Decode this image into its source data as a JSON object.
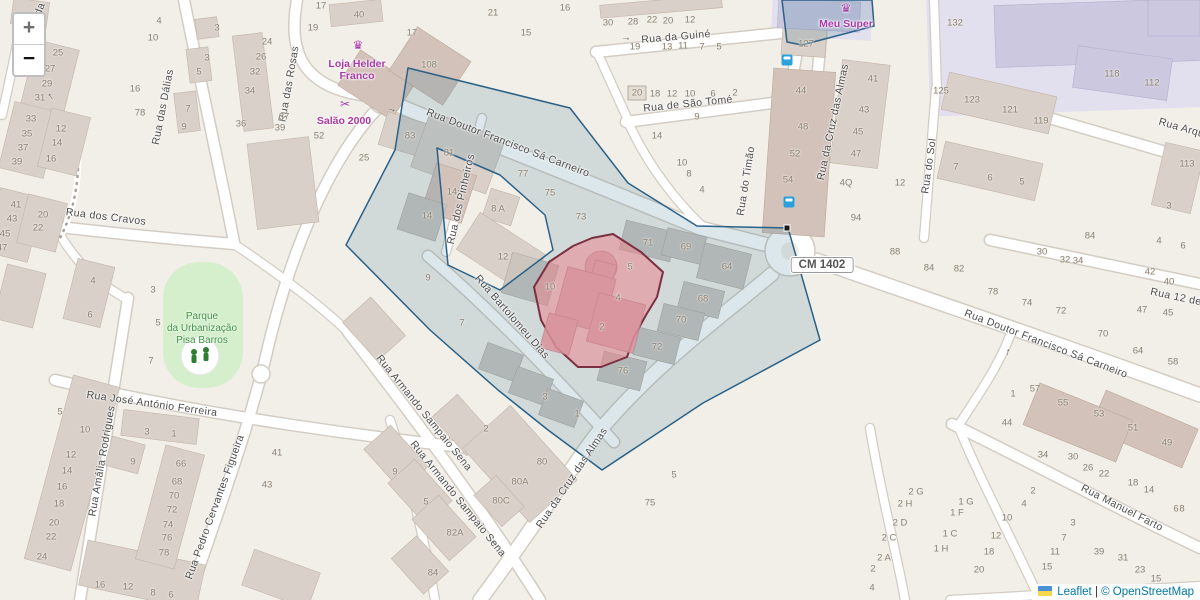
{
  "map": {
    "colors": {
      "background": "#f2efe9",
      "building": "#d9d0c9",
      "retail_building": "#cbc8e0",
      "park": "#d5efcd",
      "selection_fill": "#31708e",
      "selection_stroke": "#2a6187",
      "highlight_fill": "#ee828a",
      "highlight_stroke": "#7c2f41",
      "poi": "#aa38a6",
      "leaflet_link": "#0078A8",
      "bus": "#2aa0dc"
    },
    "controls": {
      "zoom_in": "+",
      "zoom_out": "−"
    },
    "attribution": {
      "leaflet": "Leaflet",
      "separator": " | ",
      "osm": "© OpenStreetMap"
    },
    "road_shield": "CM 1402",
    "park": {
      "name_lines": [
        "Parque",
        "da Urbanização",
        "Pisa Barros"
      ],
      "x": 202,
      "y": 329
    },
    "pois": [
      {
        "id": "loja-helder-franco",
        "lines": [
          "Loja Helder",
          "Franco"
        ],
        "icon": "crown",
        "ix": 358,
        "iy": 45,
        "x": 357,
        "y": 70
      },
      {
        "id": "salao-2000",
        "lines": [
          "Salão 2000"
        ],
        "icon": "scissors",
        "ix": 345,
        "iy": 104,
        "x": 344,
        "y": 121
      },
      {
        "id": "meu-super",
        "lines": [
          "Meu Super"
        ],
        "icon": "crown",
        "ix": 846,
        "iy": 8,
        "x": 846,
        "y": 24
      }
    ],
    "street_labels": [
      {
        "text": "Rua das Dálias",
        "x": 163,
        "y": 107,
        "rot": -79
      },
      {
        "text": "Rua das Rosas",
        "x": 289,
        "y": 84,
        "rot": -80
      },
      {
        "text": "Rua dos Cravos",
        "x": 106,
        "y": 217,
        "rot": 7
      },
      {
        "text": "Rua Doutor Francisco Sá Carneiro",
        "x": 508,
        "y": 143,
        "rot": 21
      },
      {
        "text": "Rua da Guiné",
        "x": 676,
        "y": 37,
        "rot": -5
      },
      {
        "text": "Rua de São Tomé",
        "x": 688,
        "y": 104,
        "rot": -6
      },
      {
        "text": "Rua do Timão",
        "x": 746,
        "y": 181,
        "rot": -81
      },
      {
        "text": "Rua da Cruz das Almas",
        "x": 833,
        "y": 122,
        "rot": -78
      },
      {
        "text": "Rua da Cruz das Almas",
        "x": 572,
        "y": 478,
        "rot": -56
      },
      {
        "text": "Rua Bartolomeu Dias",
        "x": 512,
        "y": 317,
        "rot": 49
      },
      {
        "text": "Rua dos Pinheiros",
        "x": 461,
        "y": 199,
        "rot": -77
      },
      {
        "text": "Rua Armando Sampaio Sena",
        "x": 424,
        "y": 413,
        "rot": 51
      },
      {
        "text": "Rua Armando Sampaio Sena",
        "x": 458,
        "y": 499,
        "rot": 51
      },
      {
        "text": "Rua José António Ferreira",
        "x": 152,
        "y": 404,
        "rot": 8
      },
      {
        "text": "Rua Amália Rodrigues",
        "x": 102,
        "y": 461,
        "rot": -80
      },
      {
        "text": "Rua Pedro Cervantes Figueira",
        "x": 215,
        "y": 507,
        "rot": -70
      },
      {
        "text": "Rua Manuel Farto",
        "x": 1122,
        "y": 508,
        "rot": 27
      },
      {
        "text": "Rua Doutor Francisco Sá Carneiro",
        "x": 1046,
        "y": 344,
        "rot": 21
      },
      {
        "text": "Rua 12 de",
        "x": 1176,
        "y": 297,
        "rot": 12
      },
      {
        "text": "Rua Arquiteto",
        "x": 1192,
        "y": 131,
        "rot": 16
      },
      {
        "text": "Rua do Sol",
        "x": 929,
        "y": 166,
        "rot": -82
      },
      {
        "text": "da",
        "x": 40,
        "y": 9,
        "rot": -70
      }
    ],
    "oneway_arrows": [
      {
        "x": 626,
        "y": 38,
        "rot": 0
      },
      {
        "x": 392,
        "y": 109,
        "rot": 20
      },
      {
        "x": 50,
        "y": 97,
        "rot": 235
      },
      {
        "x": 1007,
        "y": 352,
        "rot": 280
      }
    ],
    "bus_stops": [
      {
        "x": 787,
        "y": 60
      },
      {
        "x": 789,
        "y": 202
      }
    ],
    "house_numbers": [
      [
        "25",
        58,
        53
      ],
      [
        "27",
        50,
        69
      ],
      [
        "29",
        47,
        84
      ],
      [
        "31",
        40,
        98
      ],
      [
        "33",
        31,
        119
      ],
      [
        "35",
        27,
        134
      ],
      [
        "37",
        23,
        148
      ],
      [
        "39",
        17,
        162
      ],
      [
        "12",
        61,
        129
      ],
      [
        "14",
        57,
        143
      ],
      [
        "16",
        51,
        159
      ],
      [
        "41",
        16,
        205
      ],
      [
        "43",
        12,
        219
      ],
      [
        "45",
        5,
        234
      ],
      [
        "47",
        2,
        248
      ],
      [
        "20",
        43,
        215
      ],
      [
        "22",
        38,
        228
      ],
      [
        "4",
        159,
        21
      ],
      [
        "10",
        153,
        38
      ],
      [
        "16",
        135,
        89
      ],
      [
        "78",
        140,
        113
      ],
      [
        "7",
        188,
        109
      ],
      [
        "9",
        184,
        127
      ],
      [
        "3",
        217,
        28
      ],
      [
        "3",
        207,
        58
      ],
      [
        "5",
        199,
        72
      ],
      [
        "24",
        267,
        42
      ],
      [
        "26",
        261,
        57
      ],
      [
        "32",
        255,
        72
      ],
      [
        "34",
        250,
        91
      ],
      [
        "36",
        241,
        124
      ],
      [
        "37",
        284,
        117
      ],
      [
        "39",
        280,
        128
      ],
      [
        "52",
        319,
        136
      ],
      [
        "25",
        364,
        158
      ],
      [
        "17",
        321,
        6
      ],
      [
        "19",
        313,
        28
      ],
      [
        "40",
        359,
        15
      ],
      [
        "17",
        412,
        33
      ],
      [
        "108",
        429,
        65
      ],
      [
        "21",
        493,
        13
      ],
      [
        "15",
        526,
        33
      ],
      [
        "16",
        565,
        8
      ],
      [
        "83",
        410,
        136
      ],
      [
        "81",
        449,
        153
      ],
      [
        "77",
        523,
        174
      ],
      [
        "75",
        550,
        193
      ],
      [
        "73",
        581,
        217
      ],
      [
        "14",
        452,
        192
      ],
      [
        "14",
        427,
        216
      ],
      [
        "8 A",
        498,
        209
      ],
      [
        "12",
        503,
        257
      ],
      [
        "9",
        428,
        278
      ],
      [
        "7",
        462,
        323
      ],
      [
        "10",
        550,
        287
      ],
      [
        "5",
        630,
        267
      ],
      [
        "4",
        618,
        298
      ],
      [
        "2",
        602,
        327
      ],
      [
        "71",
        648,
        243
      ],
      [
        "69",
        686,
        247
      ],
      [
        "64",
        727,
        267
      ],
      [
        "68",
        703,
        299
      ],
      [
        "70",
        681,
        320
      ],
      [
        "72",
        657,
        347
      ],
      [
        "76",
        623,
        371
      ],
      [
        "30",
        608,
        23
      ],
      [
        "28",
        633,
        22
      ],
      [
        "22",
        652,
        20
      ],
      [
        "20",
        668,
        21
      ],
      [
        "12",
        690,
        20
      ],
      [
        "19",
        635,
        47
      ],
      [
        "13",
        667,
        47
      ],
      [
        "11",
        683,
        46
      ],
      [
        "7",
        702,
        47
      ],
      [
        "5",
        719,
        47
      ],
      [
        "20",
        637,
        93
      ],
      [
        "18",
        655,
        94
      ],
      [
        "12",
        672,
        94
      ],
      [
        "10",
        690,
        94
      ],
      [
        "6",
        713,
        94
      ],
      [
        "2",
        735,
        93
      ],
      [
        "9",
        697,
        117
      ],
      [
        "14",
        657,
        136
      ],
      [
        "10",
        682,
        163
      ],
      [
        "8",
        689,
        174
      ],
      [
        "4",
        702,
        190
      ],
      [
        "127",
        806,
        44
      ],
      [
        "44",
        801,
        91
      ],
      [
        "48",
        803,
        127
      ],
      [
        "52",
        795,
        154
      ],
      [
        "54",
        788,
        180
      ],
      [
        "41",
        873,
        79
      ],
      [
        "43",
        864,
        110
      ],
      [
        "45",
        858,
        132
      ],
      [
        "47",
        856,
        154
      ],
      [
        "4Q",
        846,
        183
      ],
      [
        "12",
        900,
        183
      ],
      [
        "94",
        856,
        218
      ],
      [
        "88",
        895,
        252
      ],
      [
        "84",
        929,
        268
      ],
      [
        "82",
        959,
        269
      ],
      [
        "132",
        955,
        23
      ],
      [
        "118",
        1112,
        74
      ],
      [
        "112",
        1152,
        83
      ],
      [
        "125",
        941,
        91
      ],
      [
        "123",
        972,
        100
      ],
      [
        "121",
        1010,
        110
      ],
      [
        "119",
        1041,
        121
      ],
      [
        "7",
        956,
        167
      ],
      [
        "6",
        990,
        178
      ],
      [
        "5",
        1022,
        182
      ],
      [
        "113",
        1187,
        164
      ],
      [
        "3",
        1169,
        206
      ],
      [
        "84",
        1090,
        236
      ],
      [
        "30",
        1042,
        252
      ],
      [
        "32",
        1065,
        260
      ],
      [
        "34",
        1078,
        261
      ],
      [
        "42",
        1150,
        272
      ],
      [
        "40",
        1169,
        282
      ],
      [
        "4",
        1159,
        241
      ],
      [
        "6",
        1183,
        246
      ],
      [
        "78",
        993,
        292
      ],
      [
        "74",
        1027,
        303
      ],
      [
        "72",
        1061,
        311
      ],
      [
        "47",
        1142,
        310
      ],
      [
        "45",
        1168,
        313
      ],
      [
        "70",
        1103,
        334
      ],
      [
        "64",
        1138,
        351
      ],
      [
        "58",
        1173,
        362
      ],
      [
        "1",
        1013,
        394
      ],
      [
        "57",
        1035,
        389
      ],
      [
        "55",
        1063,
        403
      ],
      [
        "53",
        1099,
        414
      ],
      [
        "44",
        1007,
        423
      ],
      [
        "51",
        1133,
        428
      ],
      [
        "49",
        1167,
        443
      ],
      [
        "34",
        1043,
        455
      ],
      [
        "30",
        1073,
        457
      ],
      [
        "26",
        1088,
        468
      ],
      [
        "22",
        1104,
        474
      ],
      [
        "18",
        1133,
        483
      ],
      [
        "14",
        1149,
        490
      ],
      [
        "6",
        1176,
        509
      ],
      [
        "8",
        1182,
        509
      ],
      [
        "2",
        1033,
        491
      ],
      [
        "4",
        1024,
        504
      ],
      [
        "10",
        1007,
        518
      ],
      [
        "12",
        996,
        536
      ],
      [
        "18",
        989,
        552
      ],
      [
        "20",
        979,
        570
      ],
      [
        "1 G",
        966,
        502
      ],
      [
        "1 F",
        957,
        513
      ],
      [
        "1 C",
        950,
        534
      ],
      [
        "1 H",
        941,
        549
      ],
      [
        "3",
        1073,
        523
      ],
      [
        "7",
        1064,
        538
      ],
      [
        "11",
        1055,
        552
      ],
      [
        "15",
        1047,
        567
      ],
      [
        "39",
        1099,
        552
      ],
      [
        "31",
        1123,
        558
      ],
      [
        "23",
        1140,
        570
      ],
      [
        "15",
        1156,
        579
      ],
      [
        "2 G",
        916,
        492
      ],
      [
        "2 H",
        905,
        504
      ],
      [
        "2 D",
        900,
        523
      ],
      [
        "2 C",
        889,
        538
      ],
      [
        "2 A",
        884,
        558
      ],
      [
        "2",
        873,
        569
      ],
      [
        "4",
        872,
        588
      ],
      [
        "3",
        545,
        397
      ],
      [
        "1",
        577,
        414
      ],
      [
        "2",
        486,
        429
      ],
      [
        "80",
        542,
        462
      ],
      [
        "80A",
        520,
        482
      ],
      [
        "80C",
        501,
        501
      ],
      [
        "82A",
        455,
        533
      ],
      [
        "84",
        433,
        573
      ],
      [
        "9",
        395,
        472
      ],
      [
        "5",
        426,
        502
      ],
      [
        "75",
        650,
        503
      ],
      [
        "5",
        674,
        475
      ],
      [
        "3",
        153,
        290
      ],
      [
        "5",
        158,
        323
      ],
      [
        "7",
        151,
        361
      ],
      [
        "6",
        90,
        315
      ],
      [
        "4",
        93,
        281
      ],
      [
        "41",
        277,
        453
      ],
      [
        "43",
        267,
        485
      ],
      [
        "5",
        60,
        412
      ],
      [
        "10",
        85,
        430
      ],
      [
        "12",
        71,
        455
      ],
      [
        "14",
        67,
        471
      ],
      [
        "16",
        62,
        487
      ],
      [
        "18",
        59,
        504
      ],
      [
        "20",
        54,
        523
      ],
      [
        "22",
        51,
        537
      ],
      [
        "24",
        42,
        557
      ],
      [
        "9",
        133,
        462
      ],
      [
        "3",
        147,
        432
      ],
      [
        "1",
        174,
        434
      ],
      [
        "66",
        181,
        464
      ],
      [
        "68",
        177,
        482
      ],
      [
        "70",
        174,
        496
      ],
      [
        "72",
        172,
        510
      ],
      [
        "74",
        168,
        525
      ],
      [
        "76",
        167,
        538
      ],
      [
        "78",
        164,
        553
      ],
      [
        "16",
        100,
        585
      ],
      [
        "12",
        128,
        587
      ],
      [
        "8",
        153,
        593
      ],
      [
        "6",
        171,
        595
      ]
    ]
  }
}
